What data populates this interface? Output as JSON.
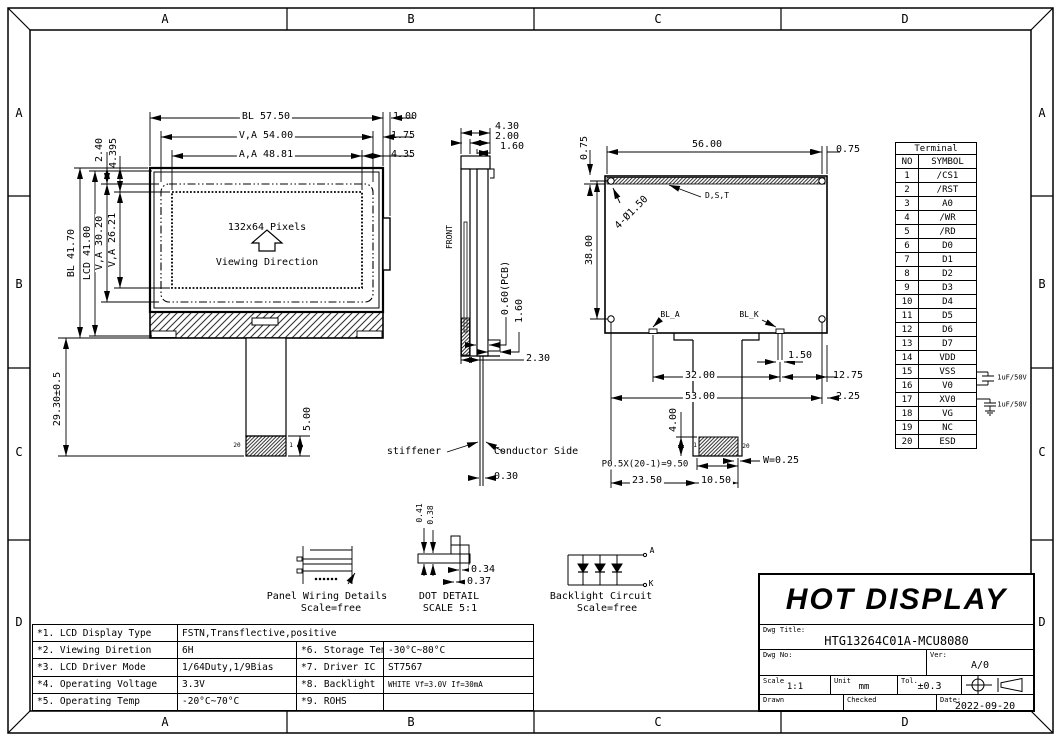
{
  "sheet": {
    "zones": [
      "A",
      "B",
      "C",
      "D"
    ]
  },
  "front_view": {
    "dim_bl_w": "BL  57.50",
    "dim_va_w": "V,A  54.00",
    "dim_aa_w": "A,A  48.81",
    "dim_1_00": "1.00",
    "dim_1_75": "1.75",
    "dim_4_35": "4.35",
    "dim_2_40": "2.40",
    "dim_4_395": "4.395",
    "dim_bl_h": "BL  41.70",
    "dim_lcd_h": "LCD  41.00",
    "dim_va_h": "V,A 30.20",
    "dim_aa_h": "V,A 26.21",
    "dim_tail": "29.30±0.5",
    "dim_stiff": "5.00",
    "pixels": "132x64 Pixels",
    "viewing": "Viewing Direction",
    "pin_left": "20",
    "pin_right": "1"
  },
  "side_view": {
    "dim_4_30": "4.30",
    "dim_2_00": "2.00",
    "dim_1_60_top": "1.60",
    "front": "FRONT",
    "dim_pcb": "0.60(PCB)",
    "dim_1_60_bot": "1.60",
    "dim_2_30": "2.30",
    "stiffener": "stiffener",
    "conductor": "Conductor Side",
    "dim_0_30": "0.30"
  },
  "back_view": {
    "dim_56": "56.00",
    "dim_0_75_r": "0.75",
    "dim_0_75_l": "0.75",
    "dim_38": "38.00",
    "holes": "4-Ø1.50",
    "dst": "D,S,T",
    "bl_a": "BL_A",
    "bl_k": "BL_K",
    "dim_1_50": "1.50",
    "dim_32": "32.00",
    "dim_12_75": "12.75",
    "dim_53": "53.00",
    "dim_2_25": "2.25",
    "dim_4_00": "4.00",
    "dim_w": "W=0.25",
    "dim_pitch": "P0.5X(20-1)=9.50",
    "dim_23_50": "23.50",
    "dim_10_50": "10.50",
    "pin_left": "1",
    "pin_right": "20"
  },
  "terminal": {
    "title": "Terminal",
    "headers": [
      "NO",
      "SYMBOL"
    ],
    "rows": [
      [
        "1",
        "/CS1"
      ],
      [
        "2",
        "/RST"
      ],
      [
        "3",
        "A0"
      ],
      [
        "4",
        "/WR"
      ],
      [
        "5",
        "/RD"
      ],
      [
        "6",
        "D0"
      ],
      [
        "7",
        "D1"
      ],
      [
        "8",
        "D2"
      ],
      [
        "9",
        "D3"
      ],
      [
        "10",
        "D4"
      ],
      [
        "11",
        "D5"
      ],
      [
        "12",
        "D6"
      ],
      [
        "13",
        "D7"
      ],
      [
        "14",
        "VDD"
      ],
      [
        "15",
        "VSS"
      ],
      [
        "16",
        "V0"
      ],
      [
        "17",
        "XV0"
      ],
      [
        "18",
        "VG"
      ],
      [
        "19",
        "NC"
      ],
      [
        "20",
        "ESD"
      ]
    ],
    "cap_top": "1uF/50V",
    "cap_bottom": "1uF/50V"
  },
  "spec": {
    "rows": [
      [
        "*1. LCD Display Type",
        "FSTN,Transflective,positive",
        "",
        ""
      ],
      [
        "*2. Viewing Diretion",
        "6H",
        "*6. Storage Temp",
        "-30°C~80°C"
      ],
      [
        "*3. LCD Driver Mode",
        "1/64Duty,1/9Bias",
        "*7. Driver IC",
        "ST7567"
      ],
      [
        "*4. Operating Voltage",
        "3.3V",
        "*8. Backlight",
        "WHITE Vf=3.0V If=30mA"
      ],
      [
        "*5. Operating Temp",
        "-20°C~70°C",
        "*9. ROHS",
        ""
      ]
    ]
  },
  "diagrams": {
    "panel_wiring": {
      "title": "Panel Wiring Details",
      "scale": "Scale=free"
    },
    "dot_detail": {
      "title": "DOT DETAIL",
      "scale": "SCALE 5:1",
      "dim_0_41": "0.41",
      "dim_0_38": "0.38",
      "dim_0_34": "0.34",
      "dim_0_37": "0.37"
    },
    "backlight": {
      "title": "Backlight Circuit",
      "scale": "Scale=free",
      "anode": "A",
      "cathode": "K"
    }
  },
  "title_block": {
    "company": "HOT DISPLAY",
    "dwg_title_label": "Dwg Title:",
    "dwg_title": "HTG13264C01A-MCU8080",
    "dwg_no_label": "Dwg No:",
    "ver_label": "Ver:",
    "ver": "A/0",
    "scale_label": "Scale",
    "scale": "1:1",
    "unit_label": "Unit",
    "unit": "mm",
    "tol_label": "Tol.",
    "tol": "±0.3",
    "drawn_label": "Drawn",
    "checked_label": "Checked",
    "date_label": "Date:",
    "date": "2022-09-20"
  }
}
